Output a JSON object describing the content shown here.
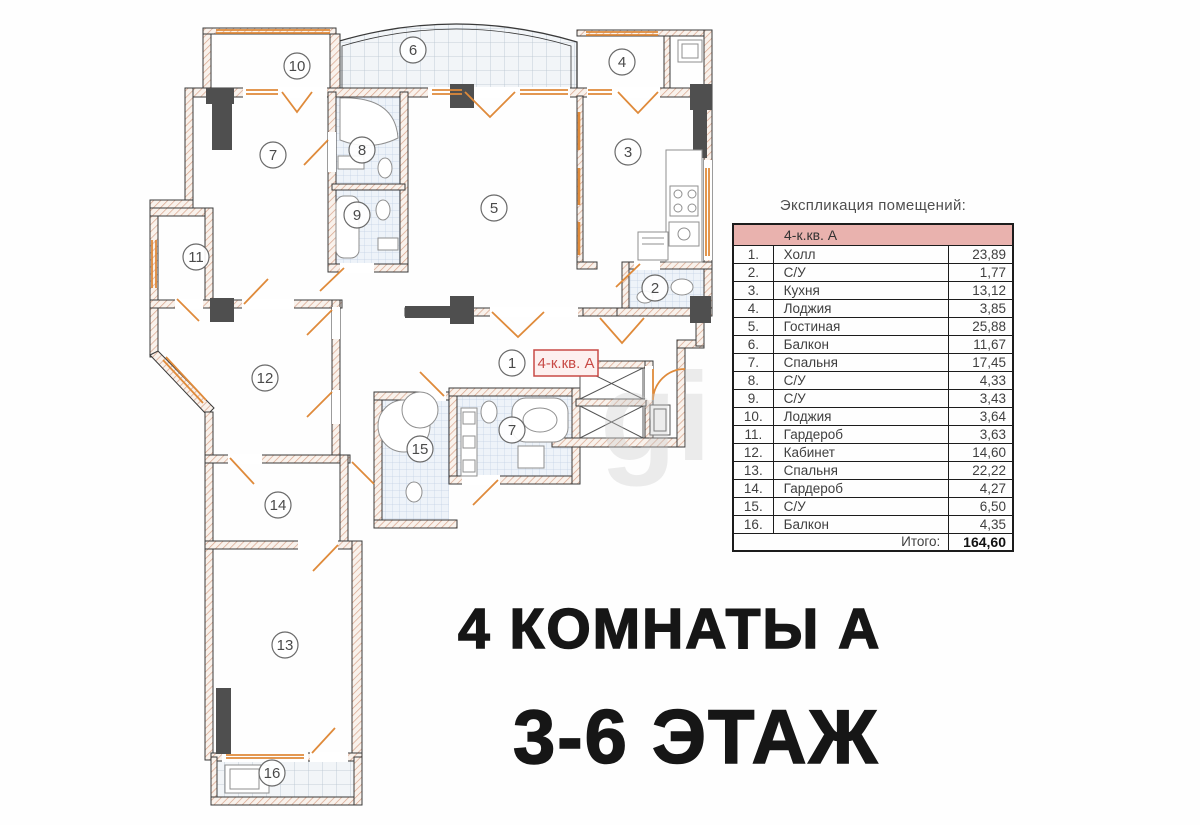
{
  "plan": {
    "markers": [
      "6",
      "10",
      "4",
      "7",
      "8",
      "9",
      "5",
      "3",
      "2",
      "11",
      "12",
      "1",
      "7",
      "15",
      "14",
      "13",
      "16"
    ],
    "apartment_label": "4-к.кв. А",
    "watermark": "gi"
  },
  "table": {
    "title": "Экспликация помещений:",
    "header": "4-к.кв. А",
    "rows": [
      {
        "num": "1.",
        "name": "Холл",
        "area": "23,89"
      },
      {
        "num": "2.",
        "name": "С/У",
        "area": "1,77"
      },
      {
        "num": "3.",
        "name": "Кухня",
        "area": "13,12"
      },
      {
        "num": "4.",
        "name": "Лоджия",
        "area": "3,85"
      },
      {
        "num": "5.",
        "name": "Гостиная",
        "area": "25,88"
      },
      {
        "num": "6.",
        "name": "Балкон",
        "area": "11,67"
      },
      {
        "num": "7.",
        "name": "Спальня",
        "area": "17,45"
      },
      {
        "num": "8.",
        "name": "С/У",
        "area": "4,33"
      },
      {
        "num": "9.",
        "name": "С/У",
        "area": "3,43"
      },
      {
        "num": "10.",
        "name": "Лоджия",
        "area": "3,64"
      },
      {
        "num": "11.",
        "name": "Гардероб",
        "area": "3,63"
      },
      {
        "num": "12.",
        "name": "Кабинет",
        "area": "14,60"
      },
      {
        "num": "13.",
        "name": "Спальня",
        "area": "22,22"
      },
      {
        "num": "14.",
        "name": "Гардероб",
        "area": "4,27"
      },
      {
        "num": "15.",
        "name": "С/У",
        "area": "6,50"
      },
      {
        "num": "16.",
        "name": "Балкон",
        "area": "4,35"
      }
    ],
    "total_label": "Итого:",
    "total_value": "164,60"
  },
  "captions": {
    "line1": "4 КОМНАТЫ А",
    "line2": "3-6 ЭТАЖ"
  },
  "colors": {
    "accent_orange": "#df8a3a",
    "table_header_pink": "#e9b2ae",
    "label_red": "#c84a46",
    "wall_hatch": "#d8a38a",
    "text_dark": "#161616"
  }
}
